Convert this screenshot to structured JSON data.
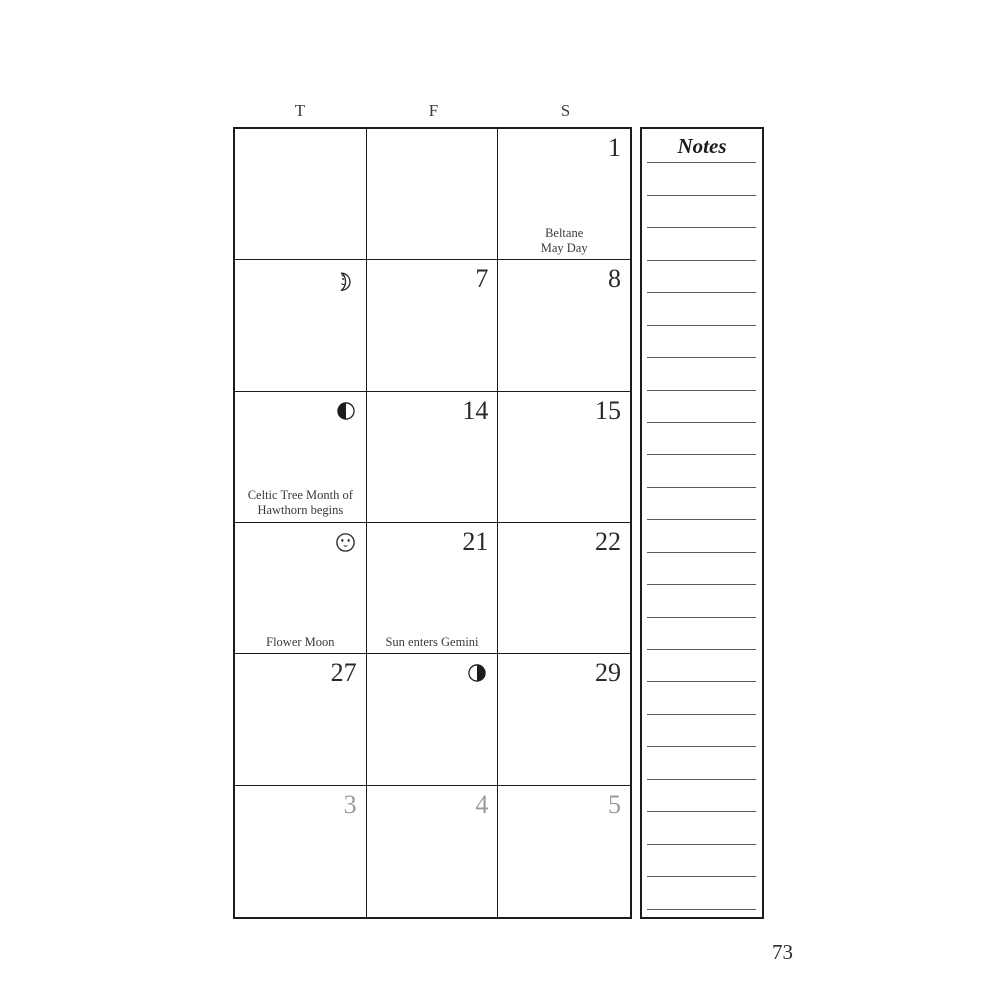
{
  "colors": {
    "ink": "#1c1c1c",
    "muted_day": "#9b9b9b",
    "note_rule": "#5a5a5a"
  },
  "weekdays": [
    "T",
    "F",
    "S"
  ],
  "grid": {
    "rows": [
      {
        "cells": [
          {
            "day": ""
          },
          {
            "day": ""
          },
          {
            "day": "1",
            "note1": "Beltane",
            "note2": "May Day"
          }
        ]
      },
      {
        "cells": [
          {
            "icon": "new-moon-crescent-with-face"
          },
          {
            "day": "7"
          },
          {
            "day": "8"
          }
        ]
      },
      {
        "cells": [
          {
            "icon": "second-quarter-half-moon-left-dark",
            "note1": "Celtic Tree Month of",
            "note2": "Hawthorn begins"
          },
          {
            "day": "14"
          },
          {
            "day": "15"
          }
        ]
      },
      {
        "cells": [
          {
            "icon": "full-moon-with-face",
            "note1": "Flower Moon"
          },
          {
            "day": "21",
            "note1": "Sun enters Gemini"
          },
          {
            "day": "22"
          }
        ]
      },
      {
        "cells": [
          {
            "day": "27"
          },
          {
            "icon": "fourth-quarter-half-moon-right-dark"
          },
          {
            "day": "29"
          }
        ]
      },
      {
        "cells": [
          {
            "day": "3",
            "muted": true
          },
          {
            "day": "4",
            "muted": true
          },
          {
            "day": "5",
            "muted": true
          }
        ]
      }
    ]
  },
  "notes_panel": {
    "title": "Notes",
    "line_count": 24
  },
  "page_number": "73"
}
